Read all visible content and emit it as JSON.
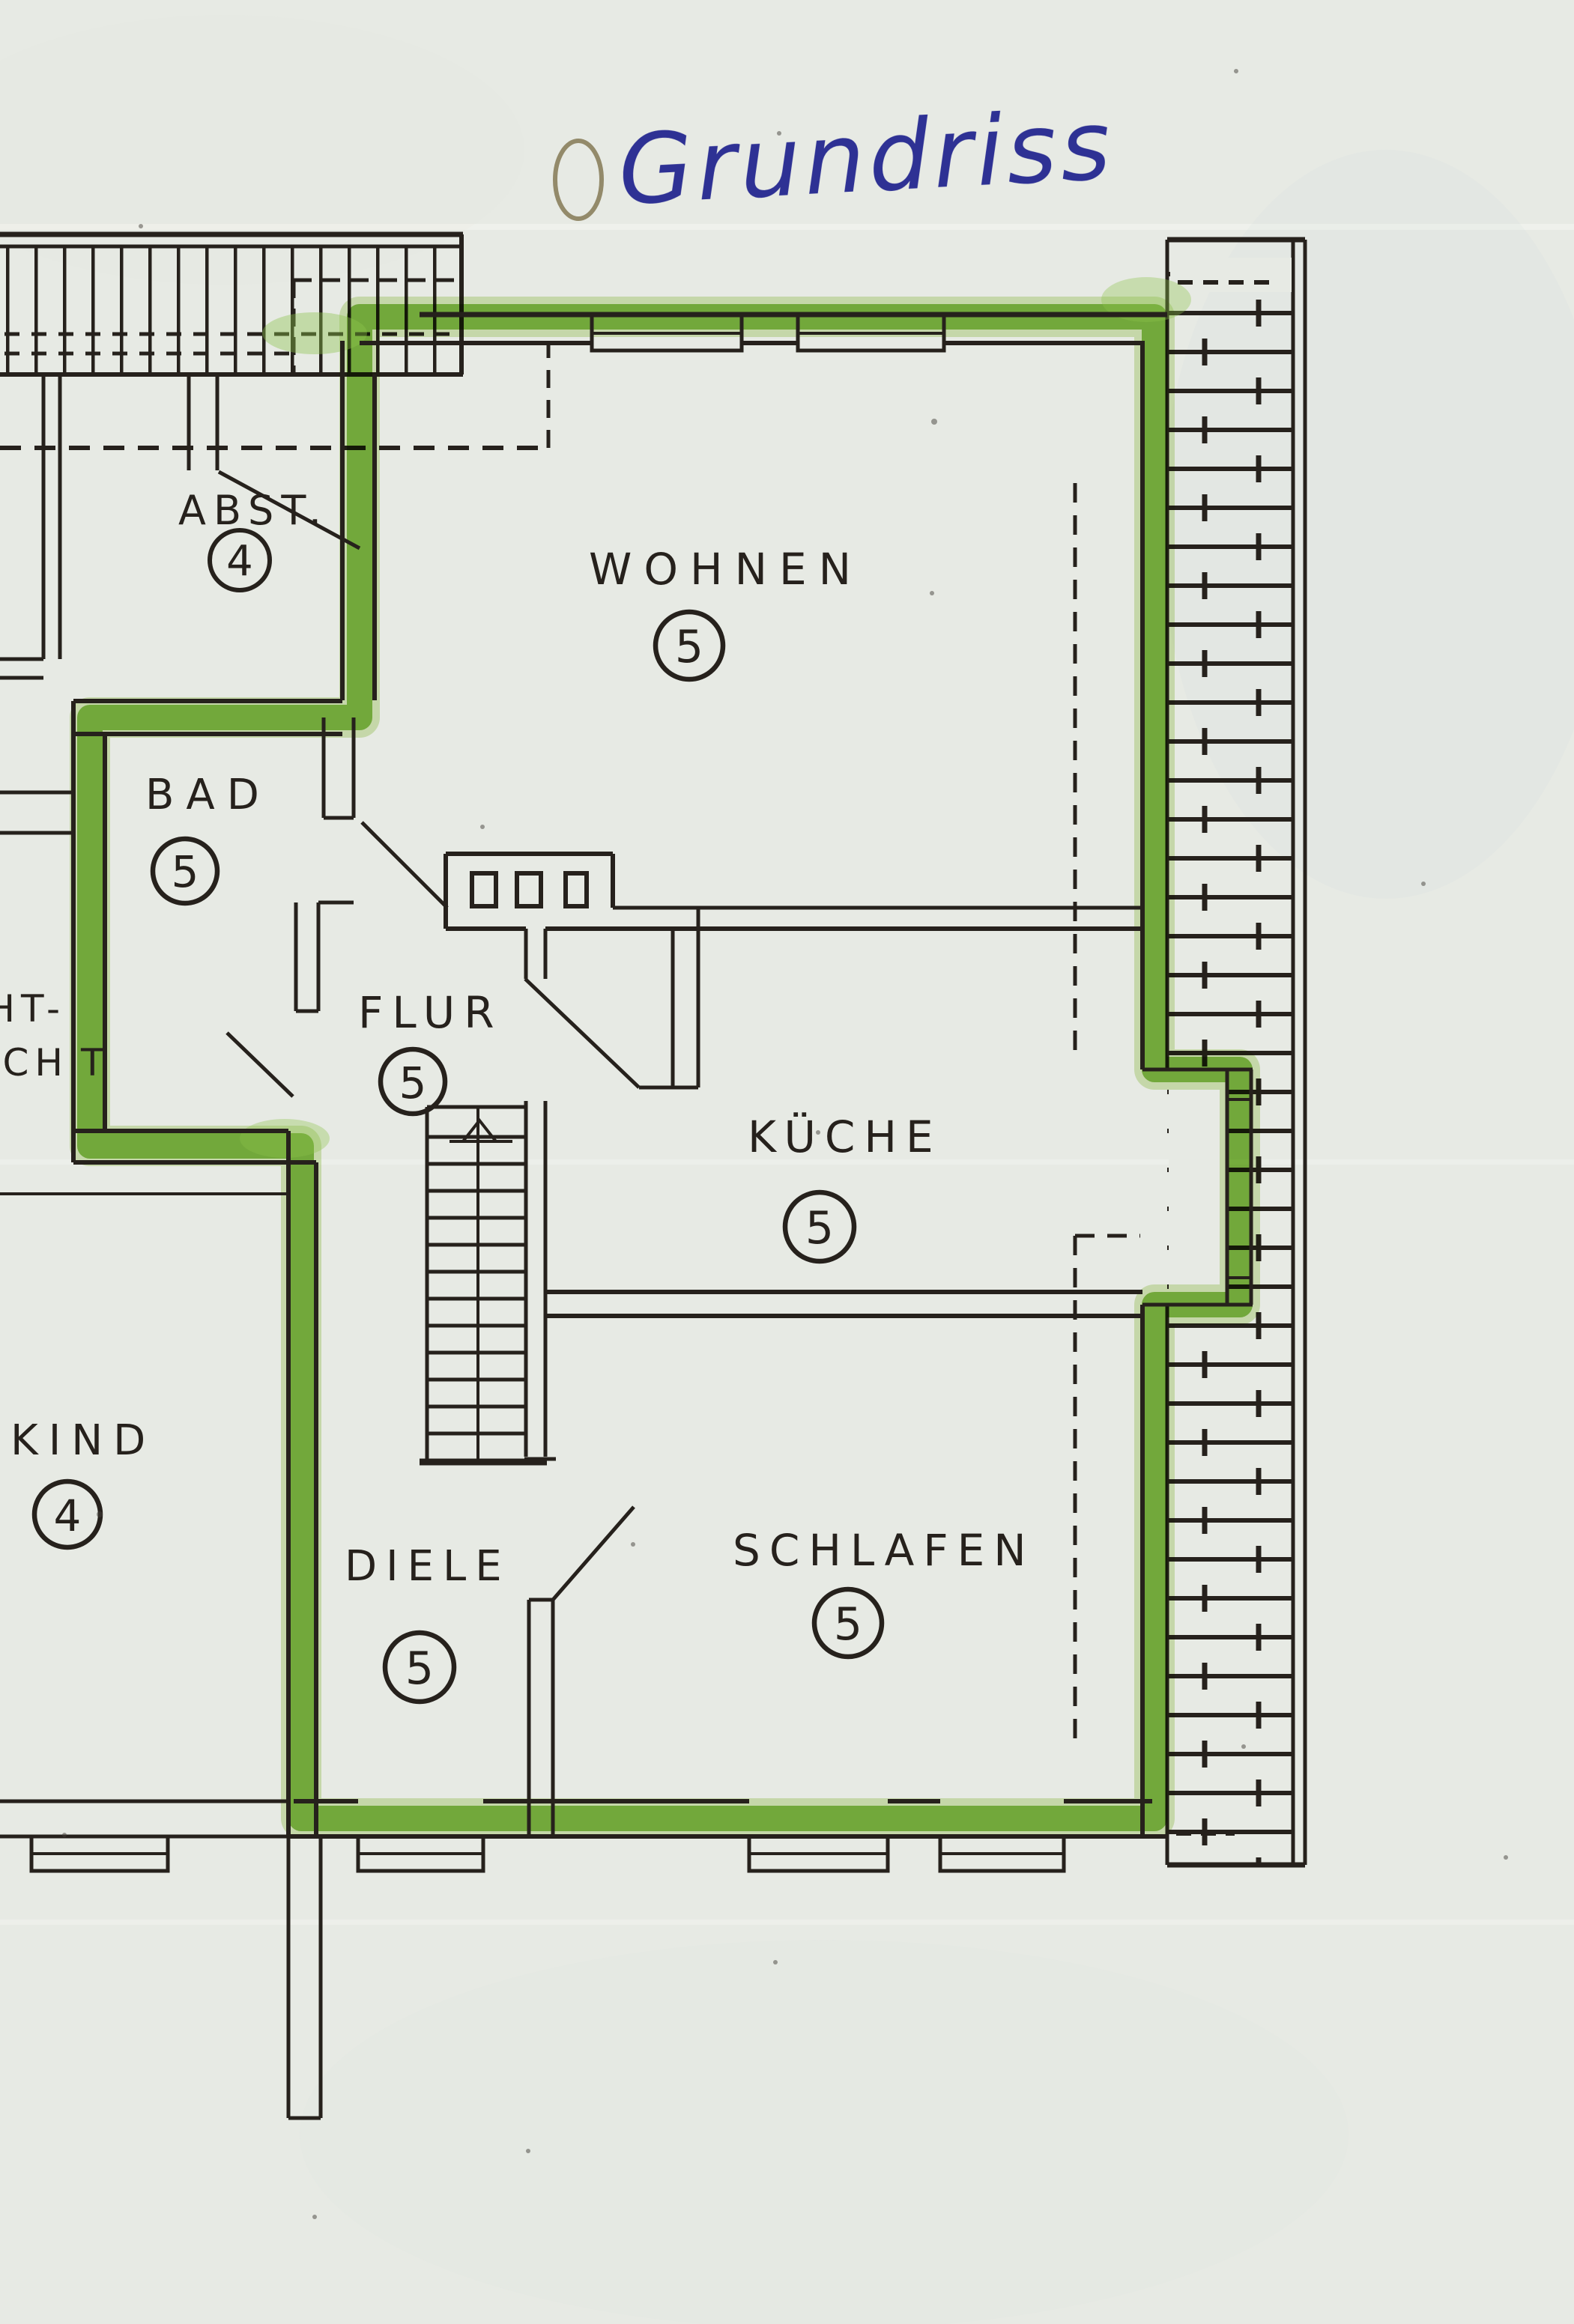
{
  "title": "Grundriss",
  "rooms": [
    {
      "id": "abst",
      "name": "ABST.",
      "number": "4"
    },
    {
      "id": "wohnen",
      "name": "WOHNEN",
      "number": "5"
    },
    {
      "id": "bad",
      "name": "BAD",
      "number": "5"
    },
    {
      "id": "flur",
      "name": "FLUR",
      "number": "5"
    },
    {
      "id": "kueche",
      "name": "KÜCHE",
      "number": "5"
    },
    {
      "id": "kind",
      "name": "KIND",
      "number": "4"
    },
    {
      "id": "diele",
      "name": "DIELE",
      "number": "5"
    },
    {
      "id": "schlafen",
      "name": "SCHLAFEN",
      "number": "5"
    }
  ],
  "partial_labels": {
    "line1": "HT-",
    "line2": "ACH",
    "line3": "T"
  },
  "colors": {
    "highlighter": "#79b92f",
    "highlighter_soft": "#abd36a",
    "ink": "#26211c",
    "pen_blue": "#2e3194",
    "paper": "#e7eae4"
  }
}
